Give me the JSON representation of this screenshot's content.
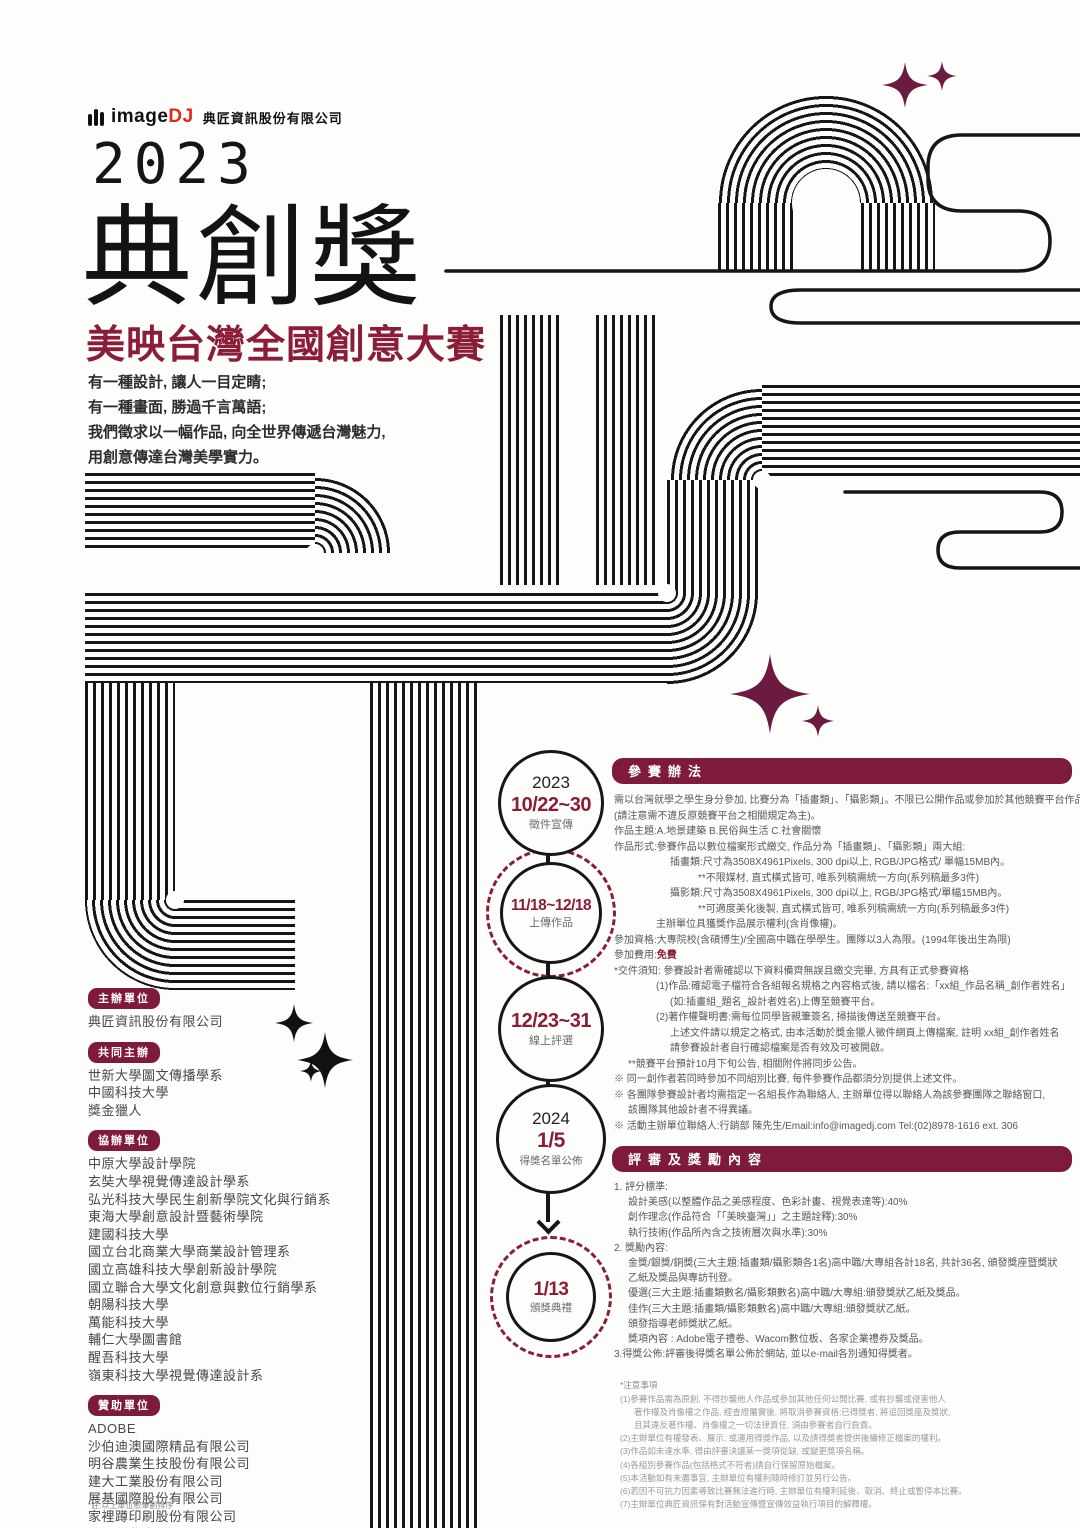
{
  "colors": {
    "accent": "#8b1d39",
    "banner_bg": "#7e1b3a",
    "sparkle": "#6b1b40",
    "ink": "#161616",
    "logo_red": "#e02820"
  },
  "brand": {
    "logo_text": "image",
    "logo_accent": "DJ",
    "company": "典匠資訊股份有限公司"
  },
  "hero": {
    "year": "2023",
    "title": "典創獎",
    "subtitle": "美映台灣全國創意大賽",
    "tagline": [
      "有一種設計, 讓人一目定睛;",
      "有一種畫面, 勝過千言萬語;",
      "我們徵求以一幅作品, 向全世界傳遞台灣魅力,",
      "用創意傳達台灣美學實力。"
    ]
  },
  "organizers": {
    "host": {
      "label": "主辦單位",
      "items": [
        "典匠資訊股份有限公司"
      ]
    },
    "cohost": {
      "label": "共同主辦",
      "items": [
        "世新大學圖文傳播學系",
        "中國科技大學",
        "獎金獵人"
      ]
    },
    "coorg": {
      "label": "協辦單位",
      "items": [
        "中原大學設計學院",
        "玄奘大學視覺傳達設計學系",
        "弘光科技大學民生創新學院文化與行銷系",
        "東海大學創意設計暨藝術學院",
        "建國科技大學",
        "國立台北商業大學商業設計管理系",
        "國立高雄科技大學創新設計學院",
        "國立聯合大學文化創意與數位行銷學系",
        "朝陽科技大學",
        "萬能科技大學",
        "輔仁大學圖書館",
        "醒吾科技大學",
        "嶺東科技大學視覺傳達設計系"
      ]
    },
    "sponsor": {
      "label": "贊助單位",
      "items": [
        "ADOBE",
        "沙伯迪澳國際精品有限公司",
        "明谷農業生技股份有限公司",
        "建大工業股份有限公司",
        "展基國際股份有限公司",
        "家裡蹲印刷股份有限公司",
        "峻揚紙業有限公司",
        "魔菇部落"
      ]
    },
    "footnote": "*註:以上單位依筆劃排序"
  },
  "timeline": [
    {
      "year": "2023",
      "date": "10/22~30",
      "label": "徵件宣傳"
    },
    {
      "year": "",
      "date": "11/18~12/18",
      "label": "上傳作品"
    },
    {
      "year": "",
      "date": "12/23~31",
      "label": "線上評選"
    },
    {
      "year": "2024",
      "date": "1/5",
      "label": "得獎名單公佈"
    },
    {
      "year": "",
      "date": "1/13",
      "label": "頒獎典禮"
    }
  ],
  "entry": {
    "heading": "參賽辦法",
    "lines": [
      {
        "t": "需以台灣就學之學生身分參加, 比賽分為「插畫類」、「攝影類」。不限已公開作品或參加於其他競賽平台作品"
      },
      {
        "t": "(請注意需不違反原競賽平台之相關規定為主)。"
      },
      {
        "t": "作品主題:A.地景建築  B.民俗與生活  C.社會關懷"
      },
      {
        "t": "作品形式:參賽作品以數位檔案形式繳交, 作品分為「插畫類」、「攝影類」兩大組:"
      },
      {
        "t": "插畫類:尺寸為3508X4961Pixels, 300 dpi以上, RGB/JPG格式/ 單幅15MB內。",
        "i": 4
      },
      {
        "t": "**不限媒材, 直式橫式皆可, 唯系列稿需統一方向(系列稿最多3件)",
        "i": 6
      },
      {
        "t": "攝影類:尺寸為3508X4961Pixels, 300 dpi以上, RGB/JPG格式/單幅15MB內。",
        "i": 4
      },
      {
        "t": "**可適度美化後製, 直式橫式皆可, 唯系列稿需統一方向(系列稿最多3件)",
        "i": 6
      },
      {
        "t": "主辦單位具獲獎作品展示權利(含肖像權)。",
        "i": 3
      },
      {
        "t": "參加資格:大專院校(含碩博生)/全國高中職在學學生。團隊以3人為限。(1994年後出生為限)"
      },
      {
        "t": "參加費用:",
        "a": "免費"
      },
      {
        "t": "*交件須知: 參賽設計者需確認以下資料備齊無誤且繳交完畢, 方具有正式參賽資格"
      },
      {
        "t": "(1)作品:確認電子檔符合各組報名規格之內容格式後, 請以檔名:「xx組_作品名稱_創作者姓名」",
        "i": 3
      },
      {
        "t": "(如:插畫組_題名_設計者姓名)上傳至競賽平台。",
        "i": 4
      },
      {
        "t": "(2)著作權聲明書:需每位同學皆親筆簽名, 掃描後傳送至競賽平台。",
        "i": 3
      },
      {
        "t": "上述文件請以規定之格式, 由本活動於獎金獵人徵件網頁上傳檔案, 註明 xx組_創作者姓名",
        "i": 4
      },
      {
        "t": "請參賽設計者自行確認檔案是否有效及可被開啟。",
        "i": 4
      },
      {
        "t": "**競賽平台預計10月下旬公告, 相關附件將同步公告。",
        "i": 1
      },
      {
        "t": "※ 同一創作者若同時參加不同組別比賽, 每件參賽作品都須分別提供上述文件。"
      },
      {
        "t": "※ 各團隊參賽設計者均需指定一名組長作為聯絡人, 主辦單位得以聯絡人為該參賽團隊之聯絡窗口,"
      },
      {
        "t": "該團隊其他設計者不得異議。",
        "i": 1
      },
      {
        "t": "※ 活動主辦單位聯絡人:行銷部 陳先生/Email:info@imagedj.com  Tel:(02)8978-1616 ext. 306"
      }
    ]
  },
  "judging": {
    "heading": "評審及獎勵內容",
    "lines": [
      {
        "t": "1. 評分標準:"
      },
      {
        "t": "設計美感(以整體作品之美感程度、色彩計畫、視覺表達等):40%",
        "i": 1
      },
      {
        "t": "創作理念(作品符合「「美映臺灣」」之主題詮釋):30%",
        "i": 1
      },
      {
        "t": "執行技術(作品所內含之技術層次與水準):30%",
        "i": 1
      },
      {
        "t": "2. 獎勵內容:"
      },
      {
        "t": "金獎/銀獎/銅獎(三大主題:插畫類/攝影類各1名)高中職/大專組各計18名, 共計36名, 頒發獎座暨獎狀",
        "i": 1
      },
      {
        "t": "乙紙及獎品與專訪刊登。",
        "i": 1
      },
      {
        "t": "優選(三大主題:插畫類數名/攝影類數名)高中職/大專組:頒發獎狀乙紙及獎品。",
        "i": 1
      },
      {
        "t": "佳作(三大主題:插畫類/攝影類數名)高中職/大專組:頒發獎狀乙紙。",
        "i": 1
      },
      {
        "t": "頒發指導老師獎狀乙紙。",
        "i": 1
      },
      {
        "t": "獎項內容 : Adobe電子禮卷、Wacom數位板、各家企業禮券及獎品。",
        "i": 1
      },
      {
        "t": "3.得獎公佈:評審後得獎名單公佈於網站, 並以e-mail各別通知得獎者。"
      }
    ]
  },
  "notes": {
    "heading": "*注意事項",
    "lines": [
      {
        "t": "(1)參賽作品需為原創, 不得抄襲他人作品或參加其他任何公開比賽, 或有抄襲或侵害他人"
      },
      {
        "t": "著作權及肖像權之作品, 經查證屬實後, 將取消參賽資格;已得獎者, 將追回獎座及獎狀,",
        "i": 1
      },
      {
        "t": "且其違反著作權、肖像權之一切法律責任, 須由參賽者自行負責。",
        "i": 1
      },
      {
        "t": "(2)主辦單位有權發表、展示, 或運用得獎作品, 以及請得獎者提供後續修正檔案的權利。"
      },
      {
        "t": "(3)作品如未達水準, 得由評審決議某一獎項從缺, 或變更獎項名稱。"
      },
      {
        "t": "(4)各組別參賽作品(包括格式不符者)請自行保留原始檔案。"
      },
      {
        "t": "(5)本活動如有未盡事宜, 主辦單位有權利隨時修訂並另行公告。"
      },
      {
        "t": "(6)若因不可抗力因素導致比賽無法進行時, 主辦單位有權利延後、取消、終止或暫停本比賽。"
      },
      {
        "t": "(7)主辦單位典匠資訊保有對活動宣傳暨宣傳效益執行項目的解釋權。"
      }
    ]
  }
}
